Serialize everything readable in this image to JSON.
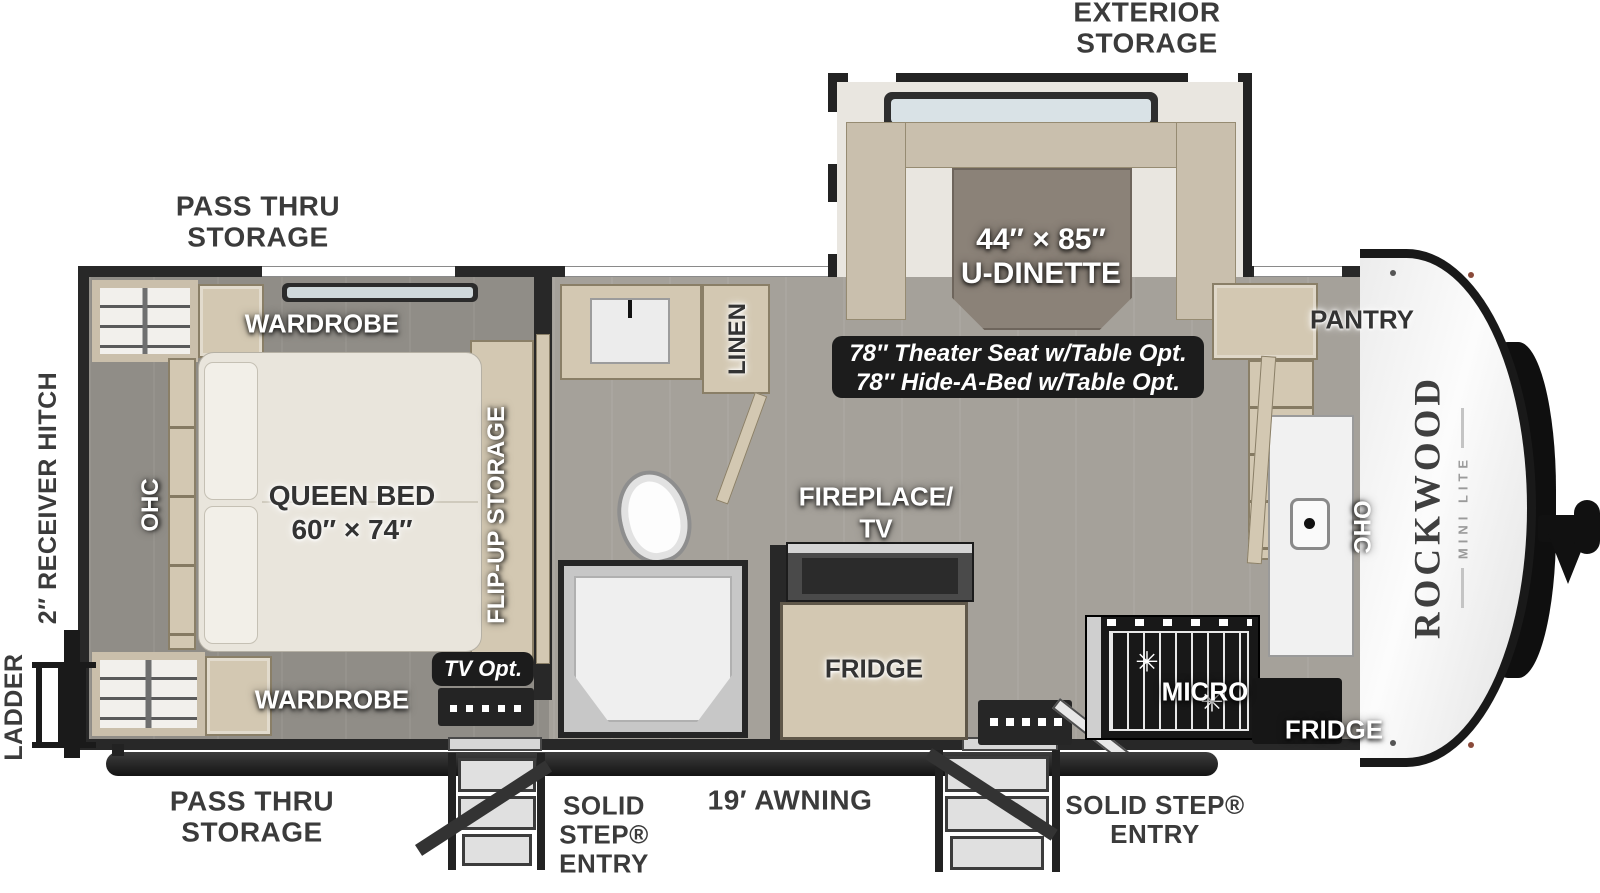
{
  "diagram": {
    "brand": {
      "name": "ROCKWOOD",
      "model": "MINI LITE"
    },
    "exterior": {
      "exterior_storage": [
        "EXTERIOR",
        "STORAGE"
      ],
      "pass_thru_top": [
        "PASS THRU",
        "STORAGE"
      ],
      "pass_thru_bottom": [
        "PASS THRU",
        "STORAGE"
      ],
      "ladder": "LADDER",
      "receiver_hitch": "2″ RECEIVER HITCH",
      "awning": "19′ AWNING",
      "entry_left": [
        "SOLID",
        "STEP®",
        "ENTRY"
      ],
      "entry_right": [
        "SOLID STEP®",
        "ENTRY"
      ]
    },
    "bedroom": {
      "wardrobe_top": "WARDROBE",
      "wardrobe_bottom": "WARDROBE",
      "bed": [
        "QUEEN BED",
        "60″ × 74″"
      ],
      "ohc": "OHC",
      "flip_up": "FLIP-UP STORAGE",
      "tv_opt": "TV Opt."
    },
    "bath": {
      "linen": "LINEN"
    },
    "living": {
      "dinette": [
        "44″ × 85″",
        "U-DINETTE"
      ],
      "options": [
        "78″ Theater Seat w/Table Opt.",
        "78″ Hide-A-Bed w/Table Opt."
      ],
      "fireplace": [
        "FIREPLACE/",
        "TV"
      ],
      "fridge": "FRIDGE"
    },
    "kitchen": {
      "pantry": "PANTRY",
      "ohc": "OHC",
      "micro": "MICRO",
      "fridge": "FRIDGE"
    }
  }
}
